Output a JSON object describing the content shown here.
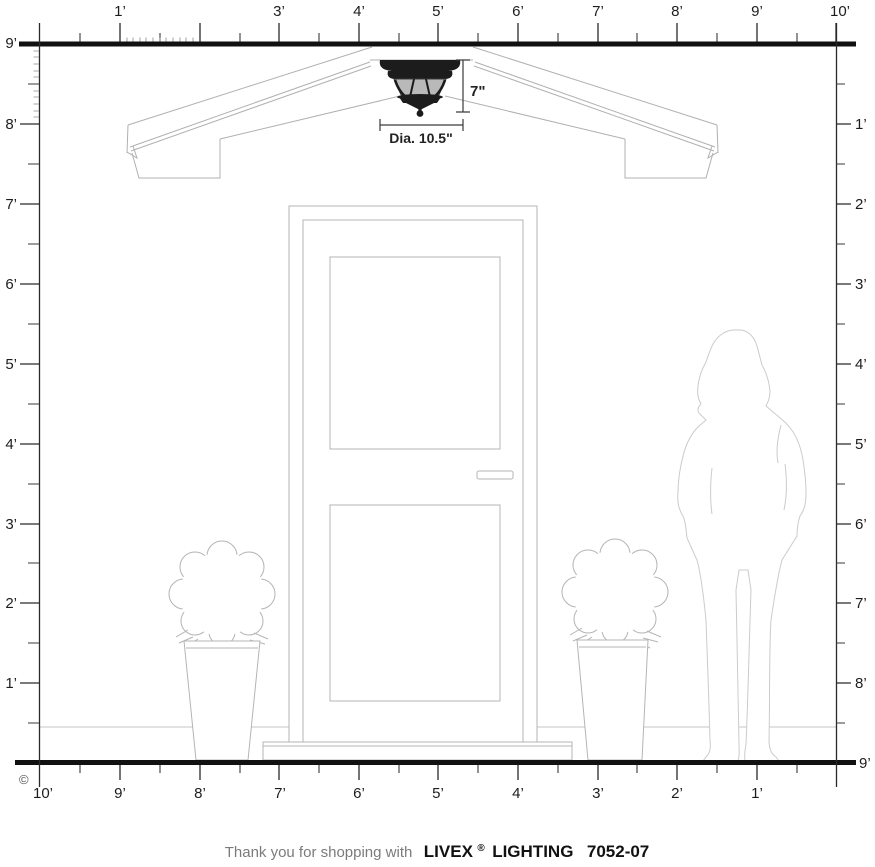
{
  "rulers": {
    "top": {
      "labels": [
        "1’",
        "3’",
        "4’",
        "5’",
        "6’",
        "7’",
        "8’",
        "9’",
        "10’"
      ]
    },
    "left": {
      "labels": [
        "9’",
        "8’",
        "7’",
        "6’",
        "5’",
        "4’",
        "3’",
        "2’",
        "1’"
      ]
    },
    "right": {
      "labels": [
        "1’",
        "2’",
        "3’",
        "4’",
        "5’",
        "6’",
        "7’",
        "8’",
        "9’"
      ]
    },
    "bottom": {
      "labels": [
        "10’",
        "9’",
        "8’",
        "7’",
        "6’",
        "5’",
        "4’",
        "3’",
        "2’",
        "1’"
      ]
    }
  },
  "fixture": {
    "height_label": "7\"",
    "diameter_label": "Dia. 10.5\""
  },
  "footer": {
    "prefix": "Thank you for shopping with",
    "brand": "LIVEX",
    "registered": "®",
    "product_line": "LIGHTING",
    "model": "7052-07"
  },
  "copyright": {
    "symbol": "©"
  },
  "colors": {
    "ink": "#1d1d1d",
    "bar": "#111111",
    "drawing_line": "#b4b4b4",
    "figure_line": "#cbcbcb",
    "fixture_body": "#1c1c1c",
    "fixture_glass": "#b9b9b9"
  }
}
